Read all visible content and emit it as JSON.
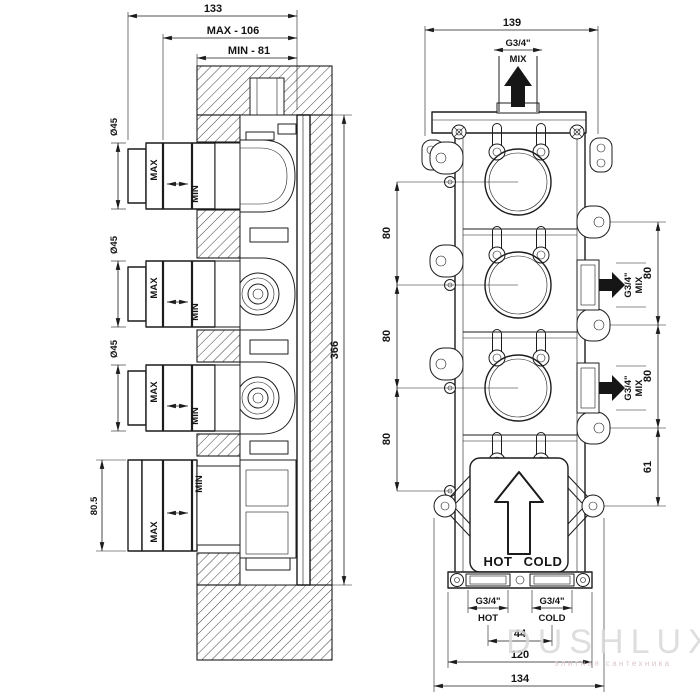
{
  "watermark": {
    "brand": "DUSHLUX",
    "tagline": "элитная сантехника"
  },
  "left_view": {
    "dim_depth_total": "133",
    "dim_depth_max": "MAX - 106",
    "dim_depth_min": "MIN - 81",
    "dim_height_total": "366",
    "dim_bottom_handle": "80.5",
    "dim_knob_diameter": "Ø45",
    "label_max": "MAX",
    "label_min": "MIN"
  },
  "right_view": {
    "dim_width_top": "139",
    "top_port": {
      "thread": "G3/4\"",
      "label": "MIX"
    },
    "side_port": {
      "thread": "G3/4\"",
      "label": "MIX"
    },
    "chain_left": [
      "80",
      "80",
      "80"
    ],
    "chain_right": [
      "80",
      "80",
      "61"
    ],
    "plate": {
      "hot": "HOT",
      "cold": "COLD"
    },
    "bottom_port_hot": {
      "thread": "G3/4\"",
      "label": "HOT"
    },
    "bottom_port_cold": {
      "thread": "G3/4\"",
      "label": "COLD"
    },
    "dim_inlet_spacing": "44",
    "dim_width_body": "120",
    "dim_width_overall": "134"
  }
}
